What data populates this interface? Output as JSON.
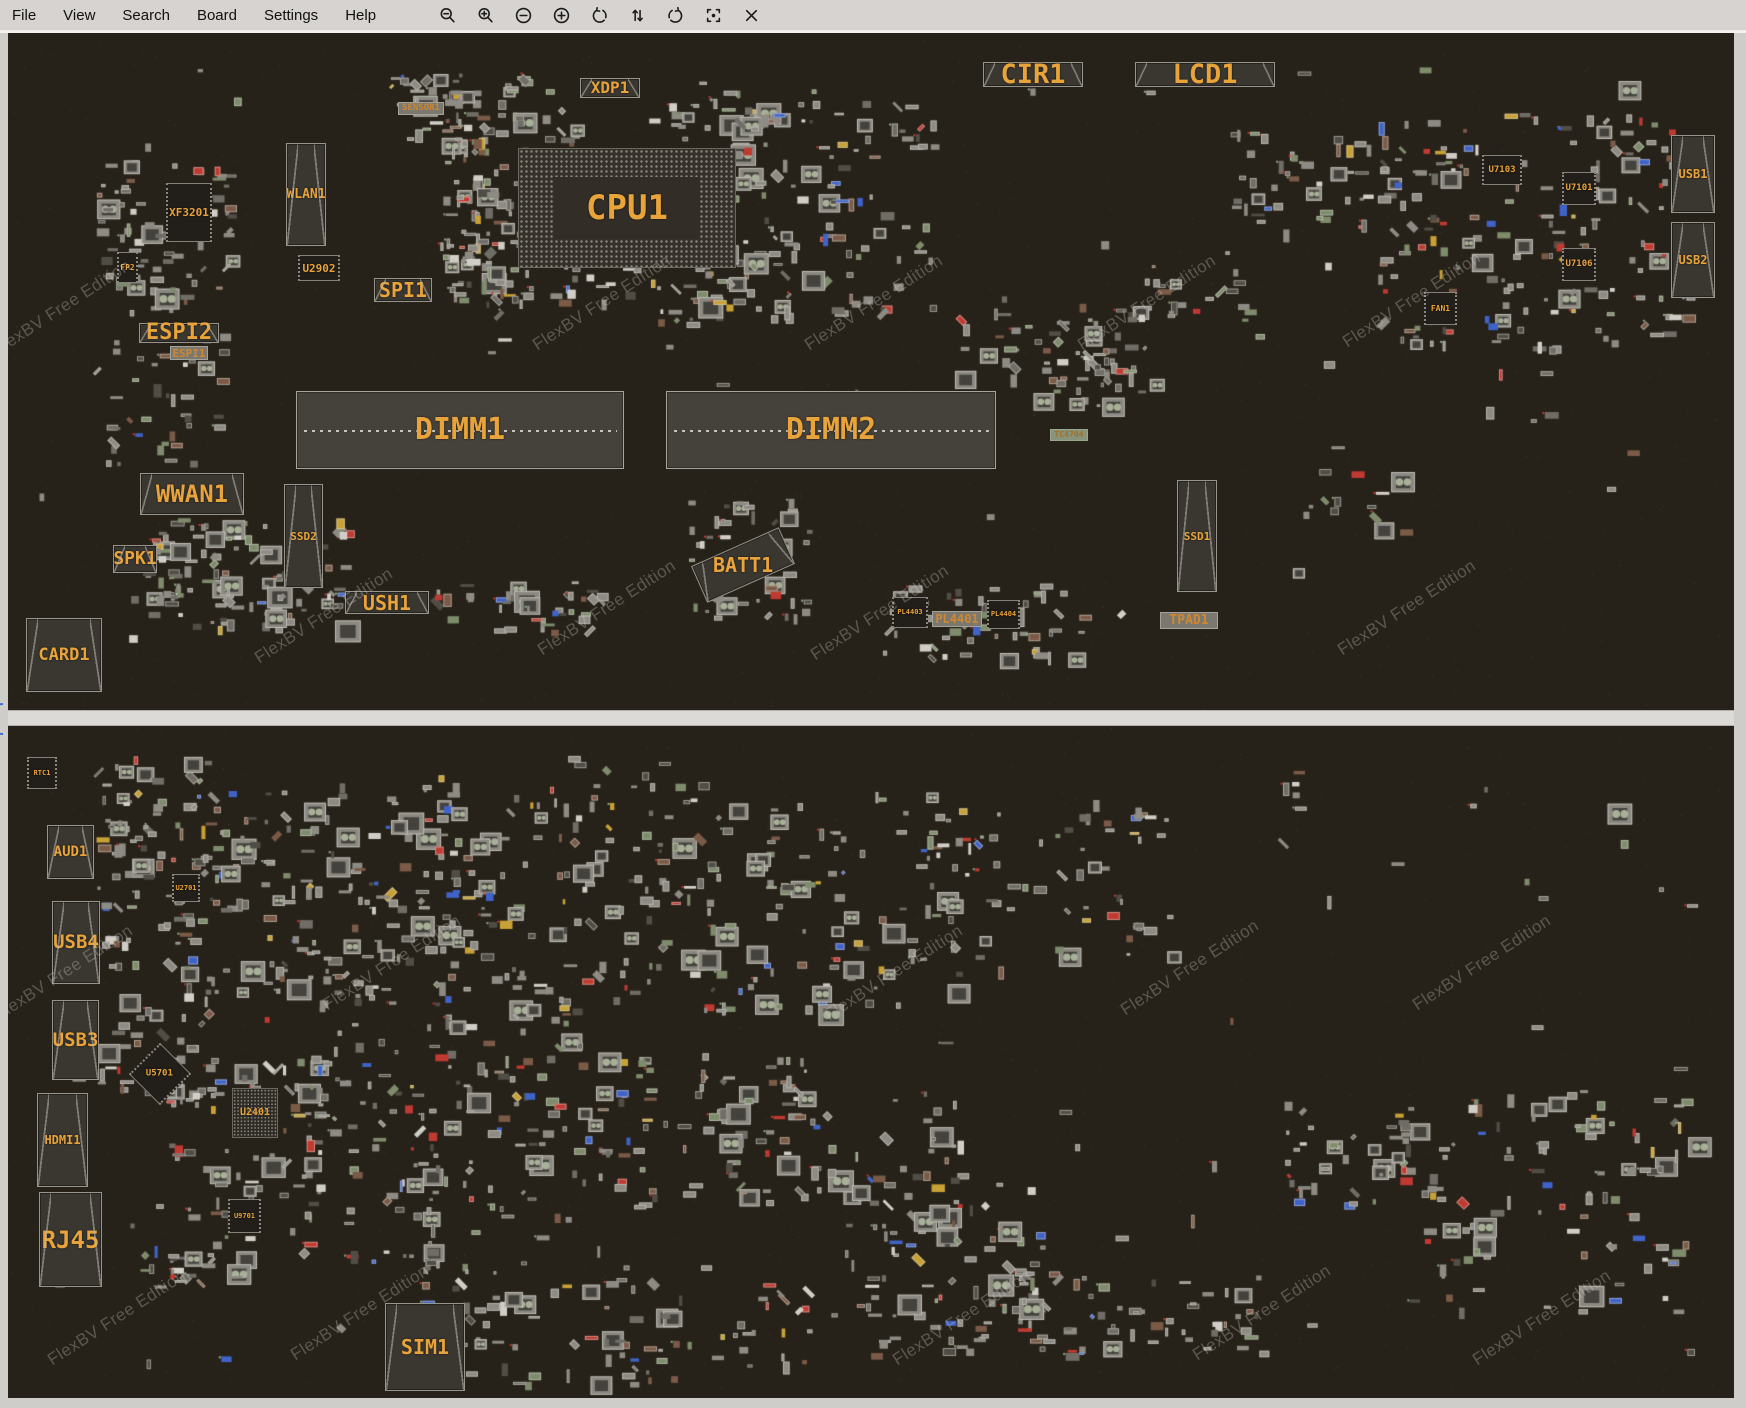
{
  "app": {
    "menus": [
      "File",
      "View",
      "Search",
      "Board",
      "Settings",
      "Help"
    ],
    "toolbar_icons": [
      "zoom-out",
      "zoom-in",
      "circle-minus",
      "circle-plus",
      "rotate-ccw",
      "flip-vertical",
      "rotate-cw",
      "center-focus",
      "close"
    ]
  },
  "watermark": {
    "text": "FlexBV Free Edition"
  },
  "colors": {
    "accent_orange": "#e8a33b",
    "board_bg": "#272219",
    "menubar_bg": "#d6d3d0",
    "split_marker_blue": "#3b6fd4"
  },
  "boards": {
    "top": {
      "components": [
        {
          "name": "cpu1",
          "label": "CPU1",
          "type": "bga",
          "x": 518,
          "y": 148,
          "w": 218,
          "h": 120,
          "fs": 34
        },
        {
          "name": "dimm1",
          "label": "DIMM1",
          "type": "dimm",
          "x": 296,
          "y": 391,
          "w": 328,
          "h": 78,
          "fs": 30
        },
        {
          "name": "dimm2",
          "label": "DIMM2",
          "type": "dimm",
          "x": 666,
          "y": 391,
          "w": 330,
          "h": 78,
          "fs": 30
        },
        {
          "name": "cir1",
          "label": "CIR1",
          "type": "conn",
          "x": 983,
          "y": 62,
          "w": 100,
          "h": 25,
          "fs": 27
        },
        {
          "name": "lcd1",
          "label": "LCD1",
          "type": "conn",
          "x": 1135,
          "y": 62,
          "w": 140,
          "h": 25,
          "fs": 27
        },
        {
          "name": "xdp1",
          "label": "XDP1",
          "type": "conn",
          "x": 580,
          "y": 78,
          "w": 60,
          "h": 20,
          "fs": 16
        },
        {
          "name": "sensor1",
          "label": "SENSOR1",
          "type": "labelbox",
          "x": 398,
          "y": 102,
          "w": 46,
          "h": 13,
          "fs": 9
        },
        {
          "name": "wlan1",
          "label": "WLAN1",
          "type": "conn",
          "x": 286,
          "y": 143,
          "w": 40,
          "h": 103,
          "fs": 13
        },
        {
          "name": "xf3201",
          "label": "XF3201",
          "type": "chip",
          "x": 166,
          "y": 183,
          "w": 46,
          "h": 59,
          "fs": 11
        },
        {
          "name": "fp2",
          "label": "FP2",
          "type": "chip",
          "x": 117,
          "y": 252,
          "w": 21,
          "h": 31,
          "fs": 8
        },
        {
          "name": "u2902",
          "label": "U2902",
          "type": "chip",
          "x": 298,
          "y": 255,
          "w": 42,
          "h": 26,
          "fs": 11
        },
        {
          "name": "spi1",
          "label": "SPI1",
          "type": "conn",
          "x": 374,
          "y": 278,
          "w": 58,
          "h": 24,
          "fs": 20
        },
        {
          "name": "espi2",
          "label": "ESPI2",
          "type": "conn",
          "x": 139,
          "y": 323,
          "w": 80,
          "h": 20,
          "fs": 22
        },
        {
          "name": "espi1",
          "label": "ESPI1",
          "type": "labelbox",
          "x": 170,
          "y": 346,
          "w": 38,
          "h": 14,
          "fs": 11
        },
        {
          "name": "wwan1",
          "label": "WWAN1",
          "type": "conn",
          "x": 140,
          "y": 473,
          "w": 104,
          "h": 42,
          "fs": 24
        },
        {
          "name": "spk1",
          "label": "SPK1",
          "type": "conn",
          "x": 113,
          "y": 545,
          "w": 44,
          "h": 28,
          "fs": 18
        },
        {
          "name": "ssd2",
          "label": "SSD2",
          "type": "conn",
          "x": 284,
          "y": 484,
          "w": 39,
          "h": 104,
          "fs": 11
        },
        {
          "name": "ush1",
          "label": "USH1",
          "type": "conn",
          "x": 345,
          "y": 591,
          "w": 84,
          "h": 23,
          "fs": 20
        },
        {
          "name": "card1",
          "label": "CARD1",
          "type": "conn",
          "x": 26,
          "y": 618,
          "w": 76,
          "h": 74,
          "fs": 17
        },
        {
          "name": "batt1",
          "label": "BATT1",
          "type": "conn",
          "x": 695,
          "y": 545,
          "w": 96,
          "h": 40,
          "fs": 20,
          "rot": -24
        },
        {
          "name": "ssd1",
          "label": "SSD1",
          "type": "conn",
          "x": 1177,
          "y": 480,
          "w": 40,
          "h": 112,
          "fs": 11
        },
        {
          "name": "tc4704",
          "label": "TC4704",
          "type": "green",
          "x": 1050,
          "y": 429,
          "w": 38,
          "h": 12,
          "fs": 8
        },
        {
          "name": "pl4403",
          "label": "PL4403",
          "type": "chip",
          "x": 892,
          "y": 597,
          "w": 36,
          "h": 31,
          "fs": 7
        },
        {
          "name": "pl4401",
          "label": "PL4401",
          "type": "labelbox",
          "x": 932,
          "y": 611,
          "w": 50,
          "h": 16,
          "fs": 12
        },
        {
          "name": "pl4404",
          "label": "PL4404",
          "type": "chip",
          "x": 987,
          "y": 600,
          "w": 33,
          "h": 29,
          "fs": 7
        },
        {
          "name": "tpad1",
          "label": "TPAD1",
          "type": "labelbox",
          "x": 1160,
          "y": 612,
          "w": 58,
          "h": 17,
          "fs": 13
        },
        {
          "name": "u7103",
          "label": "U7103",
          "type": "chip",
          "x": 1482,
          "y": 155,
          "w": 40,
          "h": 30,
          "fs": 9
        },
        {
          "name": "u7101",
          "label": "U7101",
          "type": "chip",
          "x": 1562,
          "y": 172,
          "w": 34,
          "h": 33,
          "fs": 9
        },
        {
          "name": "u7106",
          "label": "U7106",
          "type": "chip",
          "x": 1562,
          "y": 248,
          "w": 34,
          "h": 33,
          "fs": 9
        },
        {
          "name": "fan1",
          "label": "FAN1",
          "type": "chip",
          "x": 1424,
          "y": 292,
          "w": 33,
          "h": 33,
          "fs": 8
        },
        {
          "name": "usb1",
          "label": "USB1",
          "type": "conn",
          "x": 1671,
          "y": 135,
          "w": 44,
          "h": 78,
          "fs": 12
        },
        {
          "name": "usb2",
          "label": "USB2",
          "type": "conn",
          "x": 1671,
          "y": 222,
          "w": 44,
          "h": 76,
          "fs": 12
        }
      ]
    },
    "bottom": {
      "components": [
        {
          "name": "rtc1",
          "label": "RTC1",
          "type": "chip",
          "x": 27,
          "y": 757,
          "w": 30,
          "h": 32,
          "fs": 7
        },
        {
          "name": "aud1",
          "label": "AUD1",
          "type": "conn",
          "x": 47,
          "y": 825,
          "w": 47,
          "h": 54,
          "fs": 14
        },
        {
          "name": "usb4",
          "label": "USB4",
          "type": "conn",
          "x": 52,
          "y": 901,
          "w": 48,
          "h": 83,
          "fs": 19
        },
        {
          "name": "usb3",
          "label": "USB3",
          "type": "conn",
          "x": 52,
          "y": 1000,
          "w": 47,
          "h": 80,
          "fs": 19
        },
        {
          "name": "hdmi1",
          "label": "HDMI1",
          "type": "conn",
          "x": 37,
          "y": 1093,
          "w": 51,
          "h": 94,
          "fs": 12
        },
        {
          "name": "rj45",
          "label": "RJ45",
          "type": "conn",
          "x": 39,
          "y": 1192,
          "w": 63,
          "h": 95,
          "fs": 24
        },
        {
          "name": "sim1",
          "label": "SIM1",
          "type": "conn",
          "x": 385,
          "y": 1303,
          "w": 80,
          "h": 88,
          "fs": 20
        },
        {
          "name": "u2701",
          "label": "U2701",
          "type": "chip",
          "x": 172,
          "y": 874,
          "w": 28,
          "h": 28,
          "fs": 7
        },
        {
          "name": "u5701",
          "label": "U5701",
          "type": "chip",
          "x": 138,
          "y": 1052,
          "w": 44,
          "h": 44,
          "fs": 9,
          "rot": 45
        },
        {
          "name": "u2401",
          "label": "U2401",
          "type": "bga-sm",
          "x": 232,
          "y": 1088,
          "w": 46,
          "h": 50,
          "fs": 10
        },
        {
          "name": "u9701",
          "label": "U9701",
          "type": "chip",
          "x": 228,
          "y": 1199,
          "w": 33,
          "h": 34,
          "fs": 7
        }
      ]
    }
  }
}
